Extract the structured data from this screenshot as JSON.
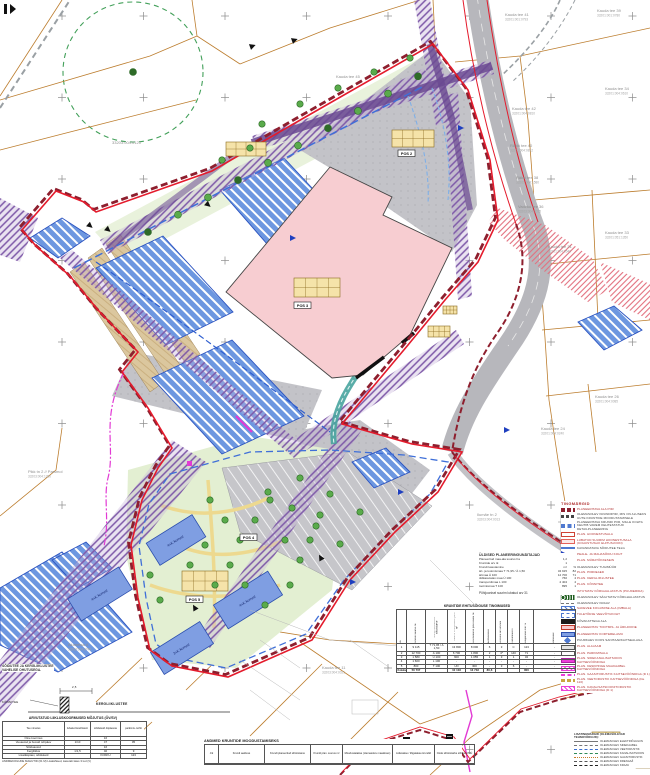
{
  "colors": {
    "accent_red": "#e41b2c",
    "boundary_dark": "#8e1f2e",
    "parcel_orange": "#bc7d2e",
    "water_blue": "#2a52c0",
    "building_pink": "#f7cdd1",
    "utility_purple": "#7d58a8",
    "magenta": "#e23ad4",
    "teal": "#48a49e"
  },
  "map_labels": [
    {
      "text": "Kauda tee 41",
      "sub": "33201:001:0793",
      "x": 505,
      "y": 16
    },
    {
      "text": "Kauda tee 39",
      "sub": "33201:001:0780",
      "x": 597,
      "y": 12
    },
    {
      "text": "Kauda tee 42",
      "sub": "33201:004:0810",
      "x": 512,
      "y": 110
    },
    {
      "text": "Räkki tee 40",
      "sub": "33201:004:0812",
      "x": 510,
      "y": 147
    },
    {
      "text": "Räkki tee 38",
      "sub": "33201:004:1580",
      "x": 516,
      "y": 179
    },
    {
      "text": "Kauda tee 34",
      "sub": "33201:004:0610",
      "x": 605,
      "y": 90
    },
    {
      "text": "Vadaku tee 36",
      "sub": "33203:004:0035",
      "x": 518,
      "y": 208
    },
    {
      "text": "Kauda tee 31",
      "sub": "33201:004:0540",
      "x": 548,
      "y": 248
    },
    {
      "text": "Kauda tee 33",
      "sub": "33201:051:1350",
      "x": 605,
      "y": 234
    },
    {
      "text": "Kauda tee 26",
      "sub": "33201:004:0085",
      "x": 595,
      "y": 398
    },
    {
      "text": "Kauda tee 24",
      "sub": "33201:004:0240",
      "x": 541,
      "y": 430
    },
    {
      "text": "Ilumäe tn 2",
      "sub": "33203:004:0013",
      "x": 477,
      "y": 516
    },
    {
      "text": "Pikk tn 2 // Parsmol",
      "sub": "33203:004:1280",
      "x": 28,
      "y": 473
    },
    {
      "text": "Kauda tee 11",
      "sub": "33203:004:0021",
      "x": 322,
      "y": 669
    },
    {
      "text": "Alumetsa 4",
      "sub": "33203:004:0740",
      "x": 68,
      "y": 646
    },
    {
      "text": "Kauda tee 45",
      "sub": "",
      "x": 336,
      "y": 78
    },
    {
      "text": "33203:004:0120",
      "sub": "",
      "x": 112,
      "y": 144
    }
  ],
  "pos_labels": [
    {
      "text": "POS 3",
      "x": 294,
      "y": 302
    },
    {
      "text": "POS 2",
      "x": 398,
      "y": 150
    },
    {
      "text": "POS 4",
      "x": 240,
      "y": 534
    },
    {
      "text": "POS 5",
      "x": 186,
      "y": 596
    }
  ],
  "building_labels": [
    {
      "text": "4+K korrust",
      "x": 176,
      "y": 542,
      "angle": -32
    },
    {
      "text": "4+K korrust",
      "x": 248,
      "y": 602,
      "angle": -32
    },
    {
      "text": "4+K korrust",
      "x": 100,
      "y": 596,
      "angle": -32
    },
    {
      "text": "3+K korrust",
      "x": 182,
      "y": 650,
      "angle": -32
    }
  ],
  "legend": {
    "title": "TINGMÄRGID",
    "items": [
      {
        "sw": "sw-areapiir",
        "c": "lr",
        "label": "PLANEERITAVA ALA PIIR"
      },
      {
        "sw": "sw-krundipiir",
        "c": "ld",
        "label": "OLEMASOLEV KRUNDIPIIR, MIS ON ALUSEKS UUTE KRUNTIDE MOODUSTAMISELE"
      },
      {
        "sw": "sw-sinine",
        "c": "ld",
        "label": "PLANEERITAVA KRUNDI PIIR, MILLE KOHTA KEHTIB VAREM KEHTESTATUD DETAILPLANEERING"
      },
      {
        "sw": "sw-hoone",
        "c": "lr",
        "label": "PLAN. HOONESTUSALA"
      },
      {
        "sw": "sw-hoone2",
        "c": "lr",
        "label": "LUBATUD SUURIM HOONESTUSALA (KOHUSTUSLIK EHITUSJOON)"
      },
      {
        "sw": "sw-line",
        "c": "ld",
        "label": "KAVANDATAVA SÕIDUTEE TELG"
      },
      {
        "sw": "sw-tri",
        "c": "lr",
        "label": "PEALE- JA MAHASÕIDU KOHT"
      },
      {
        "sw": "sw-bar",
        "c": "lr",
        "label": "PLAN. MÜRATÕKKESEIN"
      },
      {
        "sw": "sw-barsplit",
        "c": "ld",
        "label": "OLEMASOLEV TUGIMÜÜR"
      },
      {
        "sw": "sw-bar2",
        "c": "lr",
        "label": "PLAN. PIIRDEAED"
      },
      {
        "sw": "sw-yb",
        "c": "lr",
        "label": "PLAN. KERGLIIKLUSTEE"
      },
      {
        "sw": "sw-ybd",
        "c": "lr",
        "label": "PLAN. KÕNNITEE"
      },
      {
        "sw": "sw-trees",
        "c": "lr",
        "label": "ISTUTATAV KÕRGHALJASTUS (PUUDERIDA)"
      },
      {
        "sw": "sw-treesd",
        "c": "ld",
        "label": "OLEMASOLEV SÄILITATAV KÕRGHALJASTUS"
      },
      {
        "sw": "sw-dashes",
        "c": "ld",
        "label": "OLEMASOLEV KRAAV"
      },
      {
        "sw": "sw-hatchblue",
        "c": "lr",
        "label": "SADEVEE KOGUMISE ALA (IMBALA)"
      },
      {
        "sw": "sw-dashrectblue",
        "c": "lr",
        "label": "TULETÕRJE VEEVÕTUKOHT"
      },
      {
        "sw": "sw-bar",
        "c": "ld",
        "label": "KÕVAKATTEGA ALA"
      },
      {
        "sw": "sw-pink",
        "c": "lr",
        "label": "PLANEERITAV TOOTMIS- JA ÄRIHOONE"
      },
      {
        "sw": "sw-blue",
        "c": "lr",
        "label": "PLANEERITAV KORTERELAMU"
      },
      {
        "sw": "sw-diamond",
        "c": "ld",
        "label": "PUURKAEV KOOS SANITAARKAITSEALAGA"
      },
      {
        "sw": "sw-building",
        "c": "lr",
        "label": "PLAN. ALAJAAM"
      },
      {
        "sw": "sw-white",
        "c": "lr",
        "label": "PLAN. PARKIMISALA"
      },
      {
        "sw": "sw-mag",
        "c": "lr",
        "label": "PLAN. SIDEKANALISATSIOON KAITSEVÖÖNDIGA"
      },
      {
        "sw": "sw-maghatch",
        "c": "lr",
        "label": "PLAN. KESKPINGE MAAKAABEL KAITSEVÖÖNDIGA"
      },
      {
        "sw": "sw-magdash",
        "c": "lr",
        "label": "PLAN. GAASITORUSTIK KAITSEVÖÖNDIGA (D 1)"
      },
      {
        "sw": "sw-ydash",
        "c": "lr",
        "label": "PLAN. VEETORUSTIK KAITSEVÖÖNDIGA (De 110)"
      },
      {
        "sw": "sw-maghatch",
        "c": "lr",
        "label": "PLAN. KANALISATSIOONITORUSTIK KAITSEVÖÖNDIGA (D 1)"
      }
    ]
  },
  "extra_legend": {
    "title": "LISATINGMÄRGID (OLEMASOLEVAD TEHNOVÕRGUD):",
    "items": [
      {
        "style": "ls-solid-gray",
        "label": "OLEMASOLEV ELEKTRIÕHULIIN"
      },
      {
        "style": "ls-dash-gray",
        "label": "OLEMASOLEV SIDEKAABEL"
      },
      {
        "style": "ls-dashdot-blue",
        "label": "OLEMASOLEV VEETORUSTIK"
      },
      {
        "style": "ls-dash-green",
        "label": "OLEMASOLEV KANALISATSIOON"
      },
      {
        "style": "ls-dot-orange",
        "label": "OLEMASOLEV GAASITORUSTIK"
      },
      {
        "style": "ls-dashdot-gray",
        "label": "OLEMASOLEV DRENAAŽ"
      },
      {
        "style": "ls-dash-dark",
        "label": "OLEMASOLEV KRAAV"
      }
    ]
  },
  "stats": {
    "title": "ÜLDISED PLANEERINGUNÄITAJAD",
    "rows": [
      {
        "l": "Planeeritud maa-ala suurus ha",
        "v": "1,2",
        "v2": ""
      },
      {
        "l": "Kruntide arv tk",
        "v": "1",
        "v2": ""
      },
      {
        "l": "Krundi kasutamine",
        "v": "m²",
        "v2": "%"
      },
      {
        "l": "äri- ja tootmismaa T 71,95 / Ä 1,50",
        "v": "34 915",
        "v2": "82"
      },
      {
        "l": "ärimaa Ä 100",
        "v": "12 700",
        "v2": "71"
      },
      {
        "l": "üldkasutatav maa Ü 100",
        "v": "760",
        "v2": "4"
      },
      {
        "l": "transpordimaa L 100",
        "v": "2 404",
        "v2": "4"
      },
      {
        "l": "tootmismaa T 100",
        "v": "895",
        "v2": "1"
      }
    ],
    "footnote": "Põhijoonisel suurim lubatud arv  31"
  },
  "building_table": {
    "title": "KRUNTIDE EHITUSÕIGUSE TINGIMUSED",
    "columns": [
      "Jrk",
      "Krundi suurus m²",
      "Krundi kasutamise sihtotstarve",
      "Suurim ehitisealune pind m²",
      "Hoonealune pind kokku m²",
      "Korruselisus",
      "Hoonete arv krundil",
      "Parkimiskohti",
      "Haljastuse min %",
      "Märkused"
    ],
    "rows": [
      [
        "1",
        "9 115",
        "T 71,95 / Ä 1,50",
        "13 800",
        "8 000",
        "6",
        "3",
        "C",
        "123",
        "-"
      ],
      [
        "2",
        "12 700",
        "Ä 100",
        "6 700",
        "1 800",
        "2",
        "4*",
        "140",
        "71",
        "-"
      ],
      [
        "3",
        "1 580",
        "Ü 100",
        "600",
        "1 055",
        "1",
        "3",
        "1",
        "32",
        "-"
      ],
      [
        "4",
        "1 600",
        "L 100",
        "-",
        "-",
        "-",
        "-",
        "-",
        "-",
        "-"
      ],
      [
        "5",
        "800",
        "T 100",
        "UO",
        "300",
        "-",
        "3",
        "6",
        "-",
        "-"
      ]
    ],
    "footer": [
      "Kokku",
      "50 707",
      "",
      "10 103",
      "13 733",
      "80,6",
      "",
      "",
      "800",
      ""
    ]
  },
  "traffic_table": {
    "title": "ARVUTATUD LIIKLUSKOORMUSED MÕJUTUS (ÖV/SV)",
    "columns": [
      "Tee nimetus",
      "lubatud koefitsient",
      "sõidukeid ööpäevas",
      "parkimis- kohti"
    ],
    "rows": [
      [
        "Öine koormus",
        "",
        "16",
        ""
      ],
      [
        "Veoautod ja bussid öö/päev",
        "1/10",
        "47",
        "05"
      ],
      [
        "Sõiduautod",
        "",
        "16",
        ""
      ],
      [
        "Kergliiklus",
        "1/1,5",
        "40",
        "9"
      ],
      [
        "Lisatäispäev, sõidukeid",
        "",
        "KOKKU",
        "123"
      ]
    ],
    "note": "ANDMEKOGUDE MAHUTID (01 M) Lisatähised, kasutab täies 3 tud (V)"
  },
  "formation_table": {
    "title": "ANDMED KRUNTIDE MOODUSTAMISEKS",
    "columns": [
      "Jrk",
      "Krundi aadress",
      "Krundi planeeritud sihtotstarve",
      "Krundi plan. suurus m²",
      "Moodustatakse (olemasolev maaüksus)",
      "Liidetakse / lõigatakse krundid",
      "Oode sihtotstarbe sihtkood MÜ"
    ]
  },
  "section": {
    "note1": "SÕIDUTEE JA KERGLIIKLUSTEE",
    "note2": "VAHELISE OHUTUSEGA.",
    "label": "KERGLIIKLUSTEE",
    "left_label": "KÕNNITEE",
    "dim": "2,5"
  }
}
